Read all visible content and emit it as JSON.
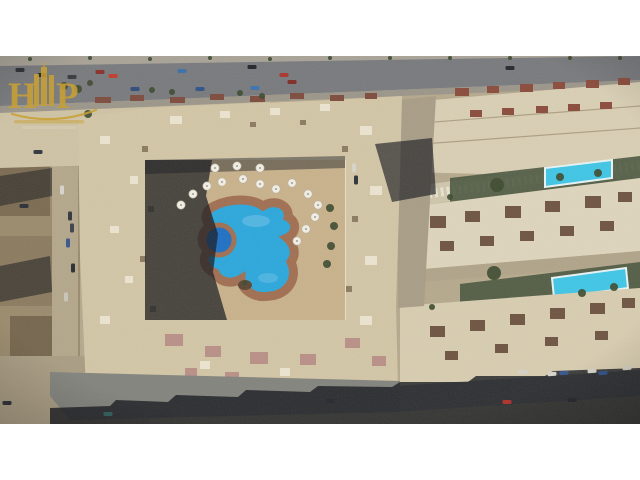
{
  "image": {
    "type": "aerial-drone-photograph",
    "subject": "Top-down aerial view of a beige residential apartment compound with a free-form blue swimming pool in its courtyard, flanked by rows of neighboring buildings with two turquoise rectangular pools, asphalt roads with cars, and desert-sand surroundings",
    "letterbox_color": "#ffffff"
  },
  "watermark": {
    "letter_left": "H",
    "letter_right": "P",
    "mark": "gold monogram with skyscraper towers, swoosh underline and small tagline lines",
    "color": "#c8a035"
  },
  "palette": {
    "letterbox": "#ffffff",
    "sand": "#b5a88c",
    "sand_light": "#c6b99b",
    "asphalt": "#77797c",
    "asphalt_dark": "#5e6063",
    "sidewalk": "#a8a296",
    "beige": "#d9cfb4",
    "beige_light": "#e6dfc9",
    "compound": "#d3c6a6",
    "deck": "#c9b28b",
    "terracotta": "#a06e50",
    "pool_blue": "#2aa7dc",
    "pool_deep": "#1d6fc4",
    "pool_turquoise": "#3ec6e6",
    "green": "#45523a",
    "tree_green": "#3c4a2e",
    "shadow": "#14161c",
    "brown": "#8a7a5e",
    "roof_red": "#8a4a3a",
    "roof_dark": "#6e5340",
    "pink": "#b98f86",
    "gold": "#c8a035"
  },
  "scene": {
    "cars": [
      [
        20,
        14,
        "#2a2d33",
        0
      ],
      [
        42,
        19,
        "#23262c",
        0
      ],
      [
        72,
        21,
        "#34383f",
        0
      ],
      [
        100,
        16,
        "#8a2f28",
        0
      ],
      [
        113,
        20,
        "#c23b2a",
        0
      ],
      [
        182,
        15,
        "#3a6fa8",
        0
      ],
      [
        252,
        11,
        "#1f2228",
        0
      ],
      [
        284,
        19,
        "#a8342a",
        0
      ],
      [
        510,
        12,
        "#23262c",
        0
      ],
      [
        135,
        33,
        "#2e4a7a",
        0
      ],
      [
        200,
        33,
        "#2f5188",
        0
      ],
      [
        255,
        32,
        "#3a72b0",
        0
      ],
      [
        292,
        26,
        "#7e2b24",
        0
      ],
      [
        354,
        112,
        "#d8d4c9",
        90
      ],
      [
        356,
        124,
        "#2d3138",
        90
      ],
      [
        62,
        134,
        "#d8d5cc",
        90
      ],
      [
        70,
        160,
        "#32363c",
        90
      ],
      [
        72,
        172,
        "#3c4048",
        90
      ],
      [
        68,
        187,
        "#35558a",
        90
      ],
      [
        73,
        212,
        "#282b31",
        90
      ],
      [
        66,
        241,
        "#c9c5ba",
        90
      ],
      [
        24,
        150,
        "#2a2e35",
        0
      ],
      [
        38,
        96,
        "#31363e",
        0
      ],
      [
        7,
        347,
        "#2b2e34",
        0
      ],
      [
        108,
        358,
        "#2f5c5a",
        0
      ],
      [
        330,
        345,
        "#23262c",
        0
      ],
      [
        523,
        316,
        "#d5d2c9",
        -4
      ],
      [
        552,
        318,
        "#d8d5cc",
        -4
      ],
      [
        564,
        317,
        "#35558a",
        -4
      ],
      [
        592,
        315,
        "#d5d2c9",
        -4
      ],
      [
        603,
        317,
        "#2e4f85",
        -4
      ],
      [
        627,
        312,
        "#d0ccc1",
        -4
      ],
      [
        507,
        346,
        "#b03028",
        0
      ],
      [
        572,
        344,
        "#22252b",
        0
      ]
    ],
    "umbrellas": [
      [
        193,
        138
      ],
      [
        207,
        130
      ],
      [
        222,
        126
      ],
      [
        243,
        123
      ],
      [
        260,
        128
      ],
      [
        276,
        133
      ],
      [
        292,
        127
      ],
      [
        308,
        138
      ],
      [
        318,
        149
      ],
      [
        181,
        149
      ],
      [
        315,
        161
      ],
      [
        306,
        173
      ],
      [
        297,
        185
      ],
      [
        260,
        112
      ],
      [
        237,
        110
      ],
      [
        215,
        112
      ]
    ],
    "trees": [
      [
        64,
        30,
        4
      ],
      [
        78,
        33,
        4
      ],
      [
        90,
        27,
        3
      ],
      [
        152,
        34,
        3
      ],
      [
        172,
        36,
        3
      ],
      [
        240,
        37,
        3
      ],
      [
        262,
        40,
        3
      ],
      [
        497,
        129,
        7
      ],
      [
        494,
        217,
        7
      ],
      [
        560,
        121,
        4
      ],
      [
        598,
        117,
        4
      ],
      [
        582,
        237,
        4
      ],
      [
        614,
        231,
        4
      ],
      [
        450,
        141,
        3
      ],
      [
        432,
        251,
        3
      ],
      [
        88,
        58,
        4
      ],
      [
        330,
        152,
        4
      ],
      [
        334,
        170,
        4
      ],
      [
        331,
        190,
        4
      ],
      [
        327,
        208,
        4
      ],
      [
        30,
        3,
        2
      ],
      [
        90,
        2,
        2
      ],
      [
        150,
        3,
        2
      ],
      [
        210,
        2,
        2
      ],
      [
        270,
        3,
        2
      ],
      [
        330,
        2,
        2
      ],
      [
        390,
        2,
        2
      ],
      [
        450,
        2,
        2
      ],
      [
        510,
        2,
        2
      ],
      [
        570,
        2,
        2
      ],
      [
        620,
        2,
        2
      ]
    ],
    "roof_blocks": [
      [
        455,
        32,
        14,
        8,
        "#8a4a3a"
      ],
      [
        487,
        30,
        12,
        7,
        "#8a4a3a"
      ],
      [
        520,
        28,
        13,
        8,
        "#8a4a3a"
      ],
      [
        553,
        26,
        12,
        7,
        "#8a4a3a"
      ],
      [
        586,
        24,
        13,
        8,
        "#8a4a3a"
      ],
      [
        618,
        22,
        12,
        7,
        "#8a4a3a"
      ],
      [
        470,
        54,
        12,
        7,
        "#8a4a3a"
      ],
      [
        502,
        52,
        12,
        7,
        "#8a4a3a"
      ],
      [
        536,
        50,
        12,
        7,
        "#8a4a3a"
      ],
      [
        568,
        48,
        12,
        7,
        "#8a4a3a"
      ],
      [
        600,
        46,
        12,
        7,
        "#8a4a3a"
      ],
      [
        95,
        41,
        16,
        6,
        "#7d4a3c"
      ],
      [
        130,
        39,
        14,
        6,
        "#7d4a3c"
      ],
      [
        170,
        41,
        15,
        6,
        "#7d4a3c"
      ],
      [
        210,
        38,
        14,
        6,
        "#7d4a3c"
      ],
      [
        250,
        40,
        15,
        6,
        "#7d4a3c"
      ],
      [
        290,
        37,
        14,
        6,
        "#7d4a3c"
      ],
      [
        330,
        39,
        14,
        6,
        "#7d4a3c"
      ],
      [
        365,
        37,
        12,
        6,
        "#7d4a3c"
      ],
      [
        430,
        160,
        16,
        12,
        "#6e5340"
      ],
      [
        465,
        155,
        15,
        11,
        "#6e5340"
      ],
      [
        505,
        150,
        16,
        12,
        "#6e5340"
      ],
      [
        545,
        145,
        15,
        11,
        "#6e5340"
      ],
      [
        585,
        140,
        16,
        12,
        "#6e5340"
      ],
      [
        618,
        136,
        14,
        10,
        "#6e5340"
      ],
      [
        440,
        185,
        14,
        10,
        "#6e5340"
      ],
      [
        480,
        180,
        14,
        10,
        "#6e5340"
      ],
      [
        520,
        175,
        14,
        10,
        "#6e5340"
      ],
      [
        560,
        170,
        14,
        10,
        "#6e5340"
      ],
      [
        600,
        165,
        14,
        10,
        "#6e5340"
      ],
      [
        430,
        270,
        15,
        11,
        "#6e5340"
      ],
      [
        470,
        264,
        15,
        11,
        "#6e5340"
      ],
      [
        510,
        258,
        15,
        11,
        "#6e5340"
      ],
      [
        550,
        252,
        15,
        11,
        "#6e5340"
      ],
      [
        590,
        247,
        15,
        11,
        "#6e5340"
      ],
      [
        622,
        242,
        13,
        10,
        "#6e5340"
      ],
      [
        445,
        295,
        13,
        9,
        "#6e5340"
      ],
      [
        495,
        288,
        13,
        9,
        "#6e5340"
      ],
      [
        545,
        281,
        13,
        9,
        "#6e5340"
      ],
      [
        595,
        275,
        13,
        9,
        "#6e5340"
      ],
      [
        165,
        278,
        18,
        12,
        "#b98f86"
      ],
      [
        205,
        290,
        16,
        11,
        "#b98f86"
      ],
      [
        250,
        296,
        18,
        12,
        "#b98f86"
      ],
      [
        300,
        298,
        16,
        11,
        "#b98f86"
      ],
      [
        345,
        282,
        15,
        10,
        "#b98f86"
      ],
      [
        372,
        300,
        14,
        10,
        "#b98f86"
      ],
      [
        225,
        316,
        14,
        9,
        "#b98f86"
      ],
      [
        185,
        312,
        12,
        8,
        "#b98f86"
      ],
      [
        100,
        80,
        10,
        8,
        "#ece4cf"
      ],
      [
        130,
        120,
        8,
        8,
        "#ece4cf"
      ],
      [
        110,
        170,
        9,
        7,
        "#ece4cf"
      ],
      [
        125,
        220,
        8,
        7,
        "#ece4cf"
      ],
      [
        100,
        260,
        10,
        8,
        "#ece4cf"
      ],
      [
        170,
        60,
        12,
        8,
        "#ece4cf"
      ],
      [
        220,
        55,
        10,
        7,
        "#ece4cf"
      ],
      [
        270,
        52,
        10,
        7,
        "#ece4cf"
      ],
      [
        320,
        48,
        10,
        7,
        "#ece4cf"
      ],
      [
        360,
        70,
        12,
        9,
        "#ece4cf"
      ],
      [
        370,
        130,
        12,
        9,
        "#ece4cf"
      ],
      [
        365,
        200,
        12,
        9,
        "#ece4cf"
      ],
      [
        360,
        260,
        12,
        9,
        "#ece4cf"
      ],
      [
        200,
        305,
        10,
        8,
        "#ece4cf"
      ],
      [
        280,
        312,
        10,
        8,
        "#ece4cf"
      ],
      [
        142,
        90,
        6,
        6,
        "#8a7a5f"
      ],
      [
        148,
        150,
        6,
        6,
        "#8a7a5f"
      ],
      [
        140,
        200,
        6,
        6,
        "#8a7a5f"
      ],
      [
        150,
        250,
        6,
        6,
        "#8a7a5f"
      ],
      [
        342,
        90,
        6,
        6,
        "#8a7a5f"
      ],
      [
        352,
        160,
        6,
        6,
        "#8a7a5f"
      ],
      [
        346,
        230,
        6,
        6,
        "#8a7a5f"
      ],
      [
        250,
        66,
        6,
        5,
        "#8a7a5f"
      ],
      [
        300,
        64,
        6,
        5,
        "#8a7a5f"
      ]
    ]
  }
}
